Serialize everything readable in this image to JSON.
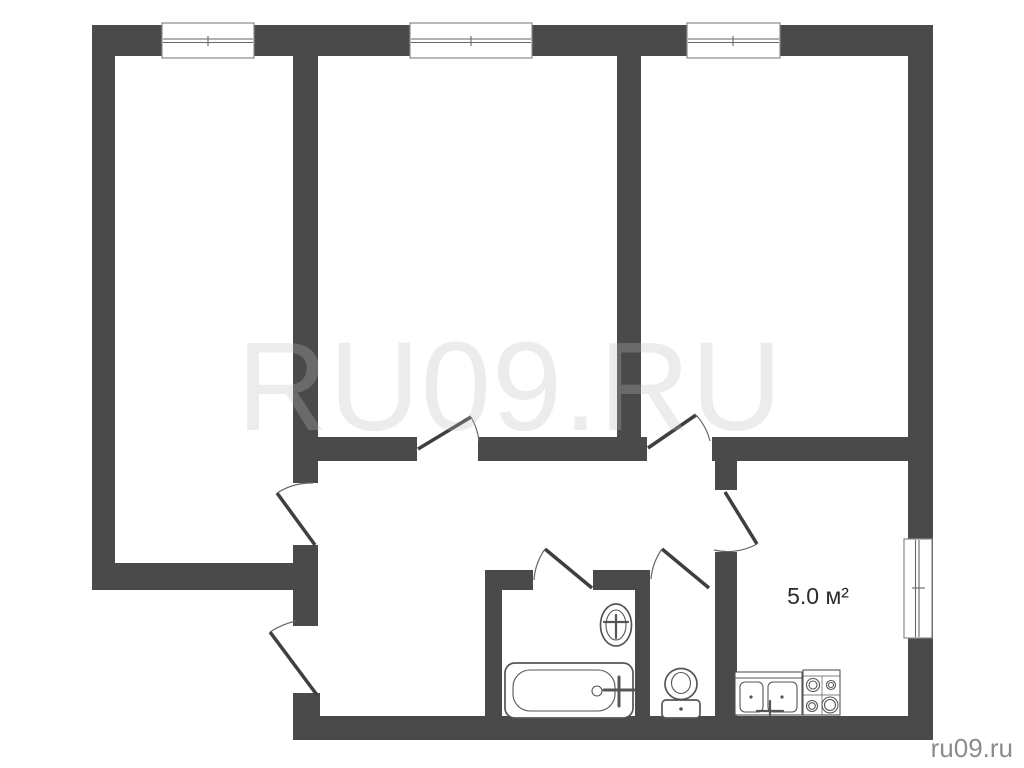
{
  "labels": {
    "watermark": "RU09.RU",
    "kitchen_area": "5.0 м²",
    "site": "ru09.ru"
  },
  "colors": {
    "background": "#ffffff",
    "wall": "#4a4a4a",
    "window-border": "#8a8a8a",
    "glass": "#666666",
    "door-leaf": "#3f3f3f",
    "swing-arc": "#666666",
    "fixture": "#555555",
    "watermark": "#bebebe",
    "area-label": "#2b2b2b",
    "site-label": "#8c8c8c"
  },
  "fixtures": {
    "bathtub": "bathtub-symbol",
    "wash_basin": "wash-basin-symbol",
    "toilet": "toilet-symbol",
    "kitchen_sink": "double-sink-symbol",
    "stove": "four-burner-stove-symbol"
  },
  "windows": {
    "count": 4,
    "positions": [
      "top-left-room",
      "top-middle-room",
      "top-right-room",
      "kitchen-right-wall"
    ]
  },
  "doors": {
    "count": 7,
    "positions": [
      "left-room",
      "middle-room",
      "right-room",
      "kitchen",
      "bathroom",
      "wc",
      "entrance"
    ]
  }
}
